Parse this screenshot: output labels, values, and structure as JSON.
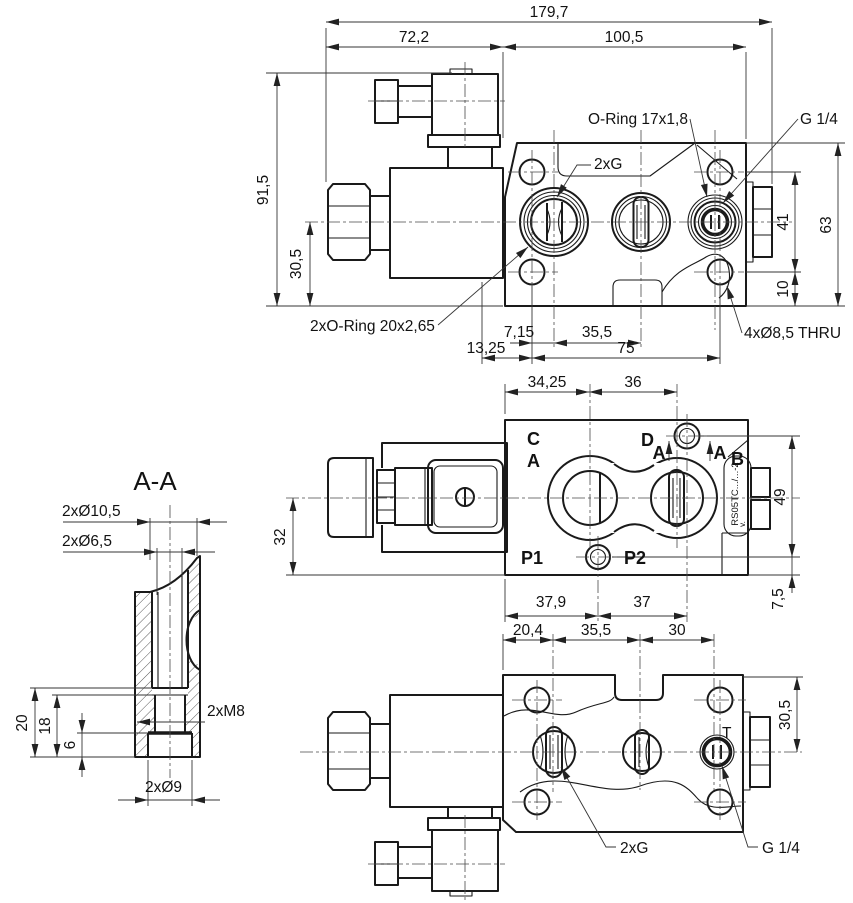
{
  "drawing": {
    "top_view": {
      "dim_overall_width": "179,7",
      "dim_solenoid_length": "72,2",
      "dim_body_width": "100,5",
      "dim_overall_height": "91,5",
      "dim_axis_height": "30,5",
      "dim_body_height": "63",
      "dim_hole_span_v": "41",
      "dim_hole_edge_v": "10",
      "dim_port1_offset": "7,15",
      "dim_port_pitch": "35,5",
      "dim_edge_offset": "13,25",
      "dim_hole_span_h": "75",
      "label_oring": "O-Ring 17x1,8",
      "label_thread": "G 1/4",
      "label_ports": "2xG",
      "label_oring2": "2xO-Ring 20x2,65",
      "label_mount_holes": "4xØ8,5 THRU"
    },
    "plan_view": {
      "dim_port1_x": "34,25",
      "dim_port2_x": "36",
      "dim_axis_offset": "32",
      "dim_hole_span": "49",
      "dim_hole_edge": "7,5",
      "dim_p_hole_x": "37,9",
      "dim_d_hole_x": "37",
      "port_c": "C",
      "port_a": "A",
      "port_d": "D",
      "port_b": "B",
      "port_p1": "P1",
      "port_p2": "P2",
      "section_mark_left": "A",
      "section_mark_right": "A",
      "stamp": "RS05TC.../...-2",
      "stamp_note": "v."
    },
    "bottom_view": {
      "dim_hole_x": "20,4",
      "dim_port_pitch1": "35,5",
      "dim_port_pitch2": "30",
      "dim_top_offset": "30,5",
      "label_t": "T",
      "label_ports": "2xG",
      "label_thread": "G 1/4"
    },
    "section_view": {
      "title": "A-A",
      "label_cbore": "2xØ10,5",
      "label_bore": "2xØ6,5",
      "label_thread": "2xM8",
      "label_cbore2": "2xØ9",
      "dim_depth_total": "20",
      "dim_depth_thread": "18",
      "dim_depth_cbore": "6"
    }
  }
}
